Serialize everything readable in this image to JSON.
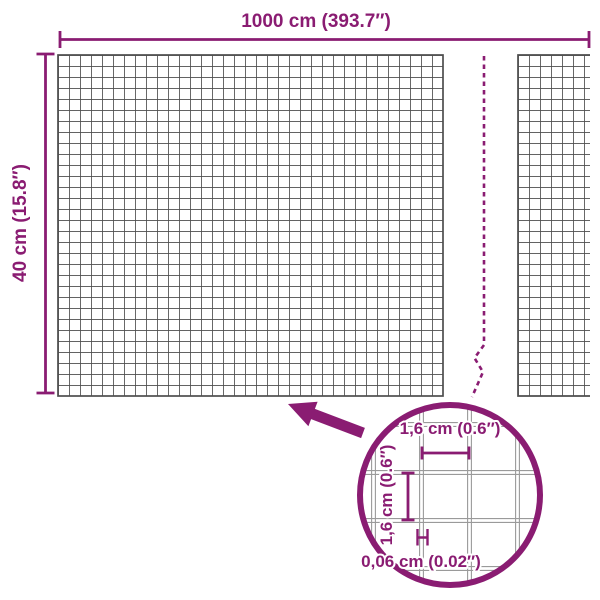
{
  "diagram": {
    "subject": "wire-mesh-roll-dimensions",
    "colors": {
      "accent": "#8a1c72",
      "mesh_wire": "#4d4d4d",
      "detail_wire": "#9a9a9a",
      "background": "#ffffff"
    },
    "labels": {
      "total_width": "1000 cm (393.7″)",
      "total_height": "40 cm (15.8″)",
      "cell_width": "1,6 cm (0.6″)",
      "cell_height": "1,6 cm (0.6″)",
      "wire_thickness": "0,06 cm (0.02″)"
    },
    "values": {
      "total_width_cm": "1000",
      "total_width_in": "393.7",
      "total_height_cm": "40",
      "total_height_in": "15.8",
      "cell_size_cm": "1,6",
      "cell_size_in": "0.6",
      "wire_thickness_cm": "0,06",
      "wire_thickness_in": "0.02"
    }
  }
}
